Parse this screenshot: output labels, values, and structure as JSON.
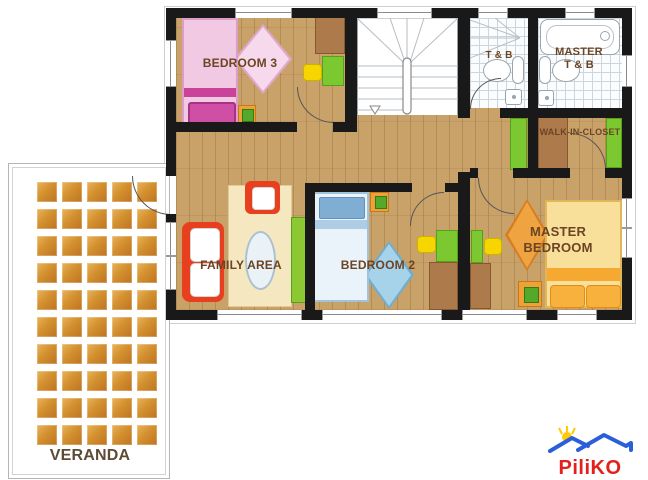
{
  "floorplan": {
    "rooms": {
      "bedroom3": {
        "label": "BEDROOM 3"
      },
      "tb": {
        "label": "T & B"
      },
      "master_tb": {
        "line1": "MASTER",
        "line2": "T & B"
      },
      "walk_in_closet": {
        "label": "WALK-IN-CLOSET"
      },
      "family_area": {
        "label": "FAMILY AREA"
      },
      "bedroom2": {
        "label": "BEDROOM 2"
      },
      "master_bedroom": {
        "line1": "MASTER",
        "line2": "BEDROOM"
      },
      "veranda": {
        "label": "VERANDA"
      }
    },
    "palette": {
      "wall": "#191919",
      "wood_floor": "#c9a26a",
      "bath_tile": "#fbfcfd",
      "label_text": "#6b4423",
      "bed_pink": "#f2c9e2",
      "bed_pink_accent": "#c9439a",
      "bed_blue": "#eaf3fa",
      "bed_blue_pillow": "#7faed2",
      "bed_yellow": "#f9e09a",
      "bed_yellow_accent": "#f5a930",
      "sofa_red": "#e8401f",
      "wardrobe_green": "#7cc831",
      "desk_brown": "#ac7a4b",
      "cushion_yellow": "#f6d500",
      "nightstand_orange": "#f0a135",
      "rug_cream": "#f5e7c0",
      "veranda_tile": "#d3902f"
    }
  },
  "logo": {
    "text": "PiliKO",
    "roof_color": "#2B5FD9",
    "sun_color": "#FFCB05",
    "text_color": "#E3201B"
  }
}
